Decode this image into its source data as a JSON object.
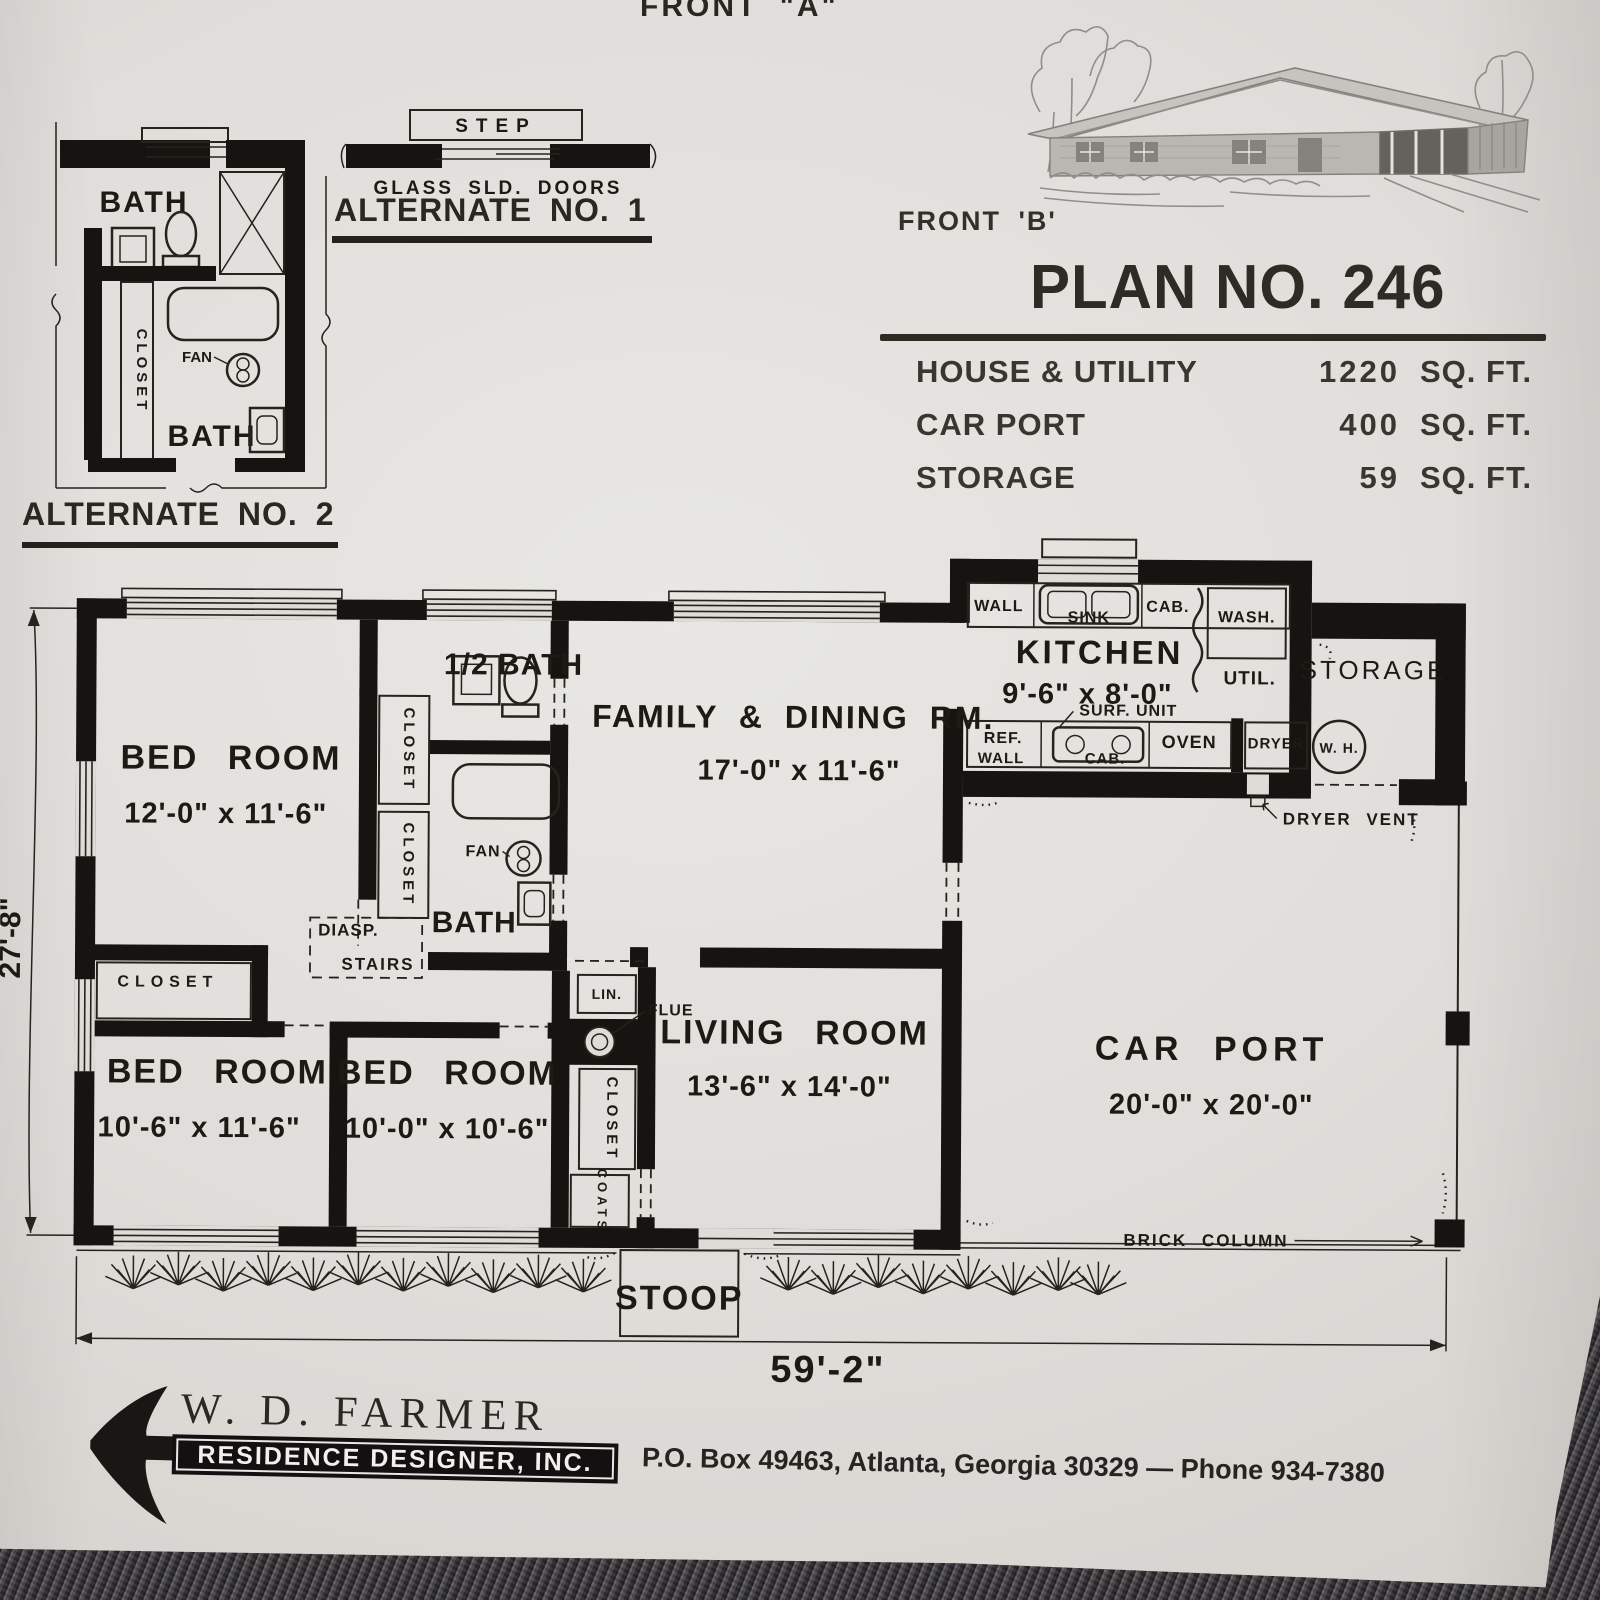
{
  "page": {
    "front_a": "FRONT \"A\"",
    "front_b": "FRONT 'B'"
  },
  "header": {
    "title": "PLAN NO. 246",
    "rows": [
      {
        "label": "HOUSE & UTILITY",
        "value": "1220",
        "unit": "SQ. FT."
      },
      {
        "label": "CAR PORT",
        "value": "400",
        "unit": "SQ. FT."
      },
      {
        "label": "STORAGE",
        "value": "59",
        "unit": "SQ. FT."
      }
    ]
  },
  "alternate1": {
    "caption": "ALTERNATE NO. 1",
    "step": "STEP",
    "doors": "GLASS SLD. DOORS"
  },
  "alternate2": {
    "caption": "ALTERNATE NO. 2",
    "bath": "BATH",
    "closet": "CLOSET",
    "fan": "FAN"
  },
  "plan": {
    "labels": {
      "bed_room": "BED ROOM",
      "half_bath": "1/2 BATH",
      "bath": "BATH",
      "fan": "FAN",
      "closet": "CLOSET",
      "coats": "COATS",
      "lin": "LIN.",
      "flue": "FLUE",
      "diasp": "DIASP.",
      "stairs": "STAIRS",
      "stoop": "STOOP",
      "wall": "WALL",
      "cab": "CAB.",
      "sink": "SINK",
      "wash": "WASH.",
      "util": "UTIL.",
      "storage": "STORAGE",
      "surf_unit": "SURF. UNIT",
      "ref": "REF.",
      "oven": "OVEN",
      "dryer": "DRYER",
      "water_heater": "W. H.",
      "dryer_vent": "DRYER VENT",
      "brick_column": "BRICK COLUMN"
    },
    "bedroom1": {
      "dims": "12'-0\" x 11'-6\""
    },
    "bedroom2": {
      "dims": "10'-6\" x 11'-6\""
    },
    "bedroom3": {
      "dims": "10'-0\" x 10'-6\""
    },
    "family": {
      "name": "FAMILY & DINING RM.",
      "dims": "17'-0\" x 11'-6\""
    },
    "living": {
      "name": "LIVING ROOM",
      "dims": "13'-6\" x 14'-0\""
    },
    "kitchen": {
      "name": "KITCHEN",
      "dims": "9'-6\" x 8'-0\""
    },
    "carport": {
      "name": "CAR PORT",
      "dims": "20'-0\" x 20'-0\""
    },
    "overall": {
      "width": "59'-2\"",
      "depth": "27'-8\""
    }
  },
  "footer": {
    "name": "W. D. FARMER",
    "tagline": "RESIDENCE DESIGNER, INC.",
    "address": "P.O. Box 49463, Atlanta, Georgia 30329 — Phone 934-7380"
  }
}
